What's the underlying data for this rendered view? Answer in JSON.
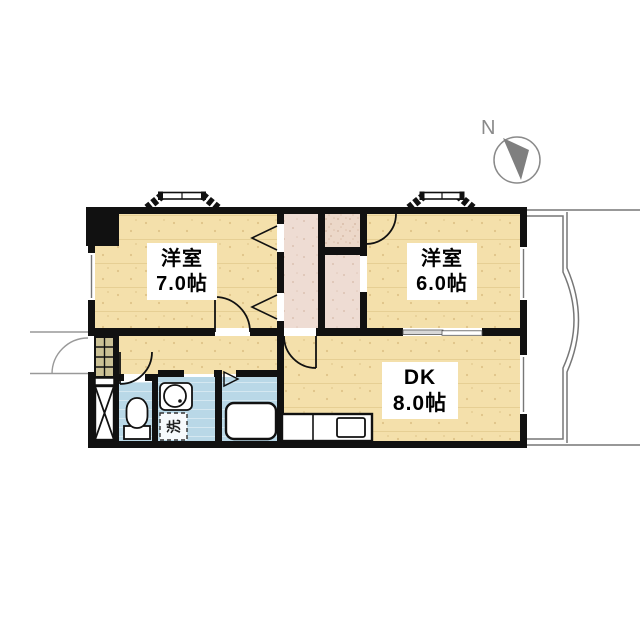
{
  "compass": {
    "label": "N"
  },
  "rooms": [
    {
      "name": "洋室",
      "size": "7.0帖"
    },
    {
      "name": "洋室",
      "size": "6.0帖"
    },
    {
      "name": "DK",
      "size": "8.0帖"
    }
  ],
  "fixtures": {
    "washing_machine": "洗"
  },
  "colors": {
    "wall": "#111111",
    "room_floor": "#f4e0ab",
    "closet_floor": "#eedcd3",
    "closet_speckle": "#ecd8c9",
    "water_area": "#b9d8e7",
    "shoe_cabinet": "#cbc195",
    "balcony_line": "#777777",
    "compass_gray": "#8a8a8a"
  }
}
